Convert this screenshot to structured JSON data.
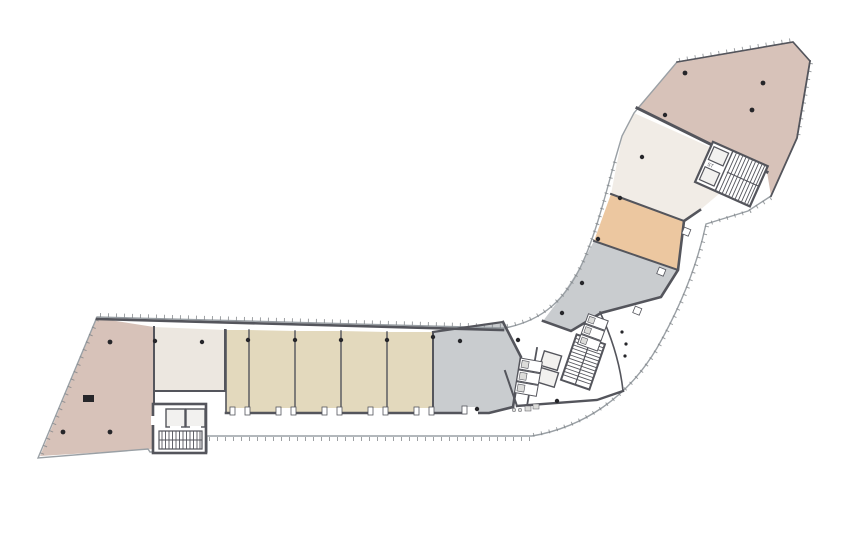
{
  "plan": {
    "type": "architectural-floor-plan",
    "labels": {
      "stair_upper": "ST"
    },
    "colors": {
      "background": "#ffffff",
      "outline": "#9aa0a5",
      "tick": "#7d8286",
      "wall": "#54555c",
      "wall_light": "#8d9094",
      "column": "#26262a",
      "core_fill": "#ffffff",
      "shaft_fill": "#f2f1ef",
      "fixture_fill": "#dcdcda",
      "room_pink": "#d7c2b9",
      "room_cream": "#ece7e0",
      "room_cream_light": "#f1ece6",
      "room_beige": "#e3d9bd",
      "room_gray": "#c9cccf",
      "room_orange": "#ecc7a0"
    },
    "rooms": [
      {
        "name": "open-plan-lower-left",
        "color_key": "room_pink"
      },
      {
        "name": "room-lower-cream",
        "color_key": "room_cream"
      },
      {
        "name": "unit-1",
        "color_key": "room_beige"
      },
      {
        "name": "unit-2",
        "color_key": "room_beige"
      },
      {
        "name": "unit-3",
        "color_key": "room_beige"
      },
      {
        "name": "unit-4",
        "color_key": "room_beige"
      },
      {
        "name": "unit-5",
        "color_key": "room_beige"
      },
      {
        "name": "room-gray-south",
        "color_key": "room_gray"
      },
      {
        "name": "room-gray-elbow",
        "color_key": "room_gray"
      },
      {
        "name": "room-orange",
        "color_key": "room_orange"
      },
      {
        "name": "room-cream-upper",
        "color_key": "room_cream_light"
      },
      {
        "name": "open-plan-upper-right",
        "color_key": "room_pink"
      }
    ],
    "cores": [
      {
        "name": "lower-left-core",
        "features": [
          "elevator",
          "elevator",
          "stair"
        ]
      },
      {
        "name": "central-core",
        "features": [
          "stair",
          "elevator",
          "elevator",
          "wc-stalls"
        ]
      },
      {
        "name": "upper-right-core",
        "features": [
          "elevator",
          "stair"
        ]
      }
    ]
  }
}
